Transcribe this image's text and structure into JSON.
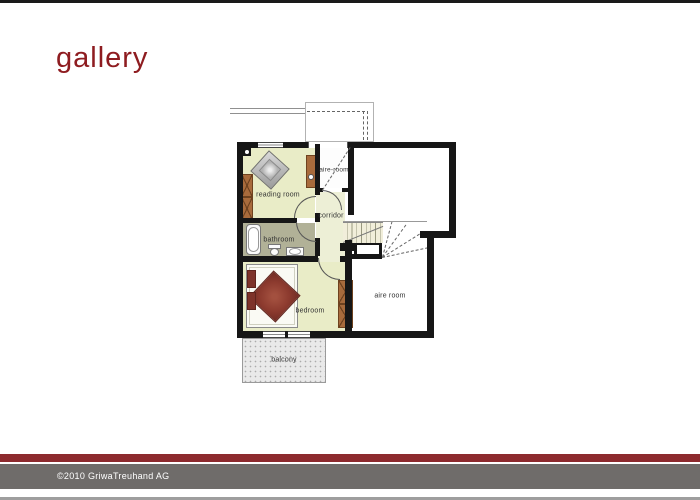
{
  "page": {
    "title": "gallery"
  },
  "footer": {
    "copyright": "©2010 GriwaTreuhand AG"
  },
  "floorplan": {
    "rooms": [
      {
        "id": "reading-room",
        "label": "reading room"
      },
      {
        "id": "aire-room-upper",
        "label": "aire-room"
      },
      {
        "id": "corridor",
        "label": "corridor"
      },
      {
        "id": "bathroom",
        "label": "bathroom"
      },
      {
        "id": "bedroom",
        "label": "bedroom"
      },
      {
        "id": "aire-room",
        "label": "aire room"
      },
      {
        "id": "balcony",
        "label": "balcony"
      }
    ],
    "furniture": [
      "armchair",
      "shelf",
      "sideboard",
      "bathtub",
      "toilet",
      "sink",
      "double-bed",
      "wardrobe",
      "staircase"
    ],
    "colors": {
      "accent_red": "#8e1c20",
      "footer_bar_red": "#8d2a2e",
      "footer_bar_gray": "#6f6c6a",
      "wall": "#161616",
      "room_floor": "#e9ecc7",
      "bathroom_floor": "#b1b197",
      "wood": "#a86b3c",
      "bed_textile": "#8c3a2e",
      "stair_tread": "#f1eeda",
      "balcony_floor": "#e9e9e9"
    }
  }
}
